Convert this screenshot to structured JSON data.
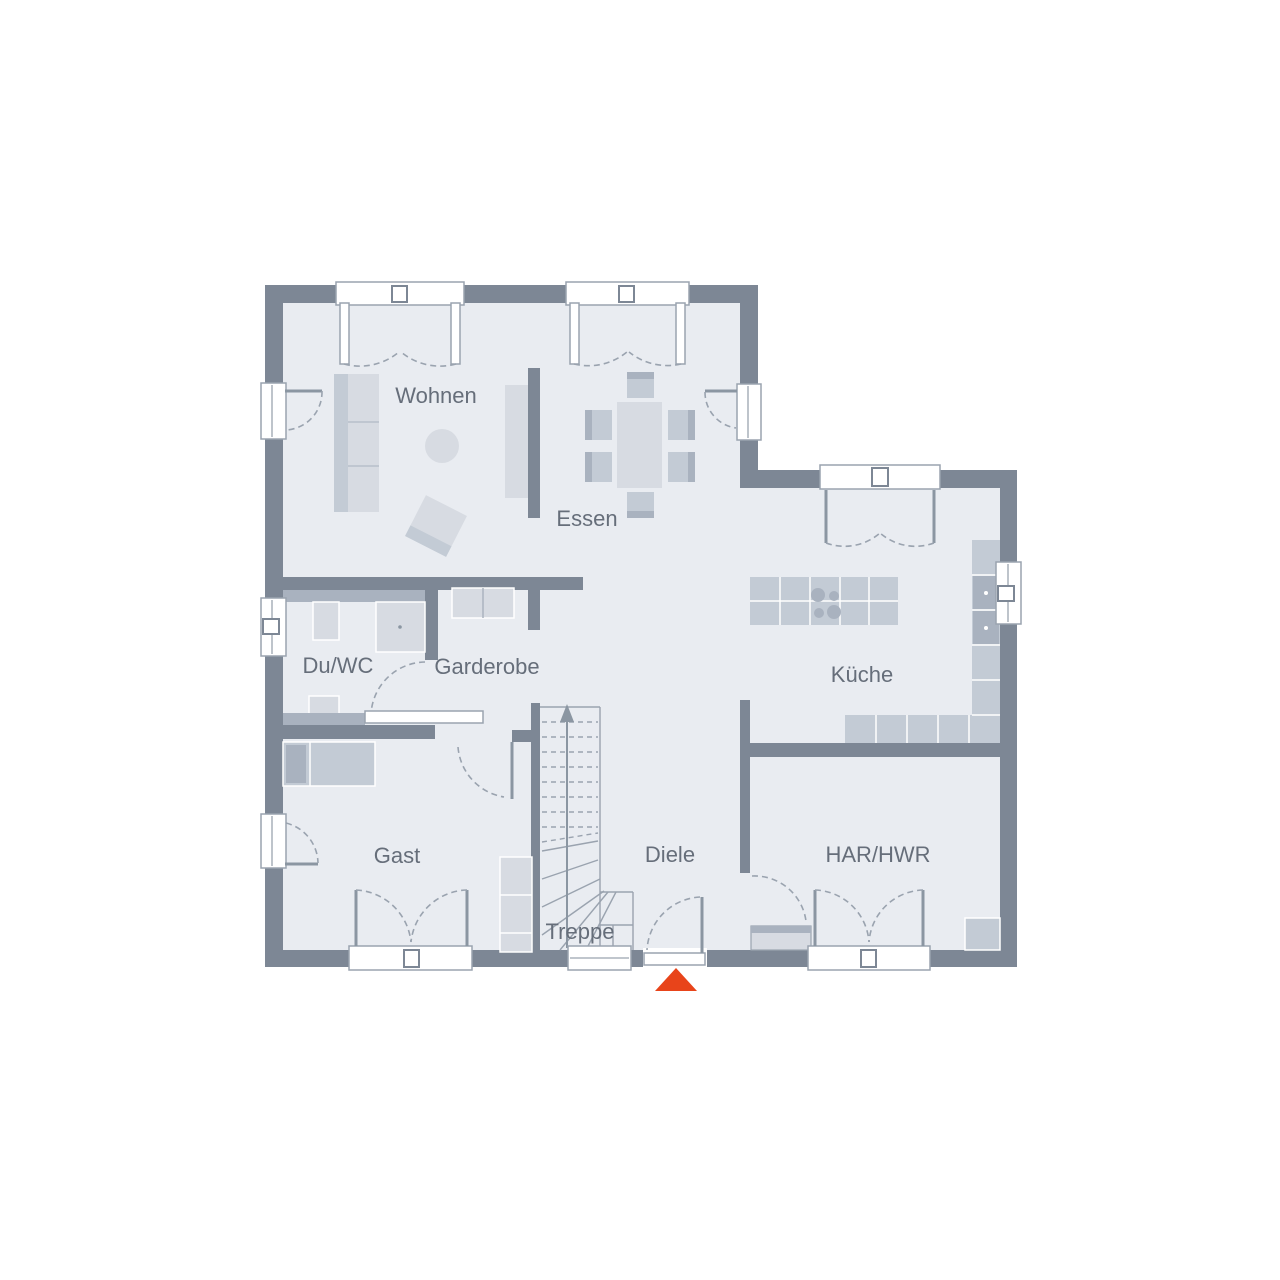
{
  "rooms": {
    "wohnen": "Wohnen",
    "essen": "Essen",
    "duwc": "Du/WC",
    "garderobe": "Garderobe",
    "kueche": "Küche",
    "gast": "Gast",
    "diele": "Diele",
    "treppe": "Treppe",
    "har": "HAR/HWR"
  },
  "colors": {
    "wall": "#7d8795",
    "floor": "#e9ecf1",
    "furniture_light": "#d7dbe2",
    "furniture_mid": "#c3cbd5",
    "furniture_dark": "#a9b2bf",
    "line": "#9aa3af",
    "leaf": "#8b96a2",
    "text": "#666e7a",
    "entrance_arrow": "#e8441a"
  }
}
